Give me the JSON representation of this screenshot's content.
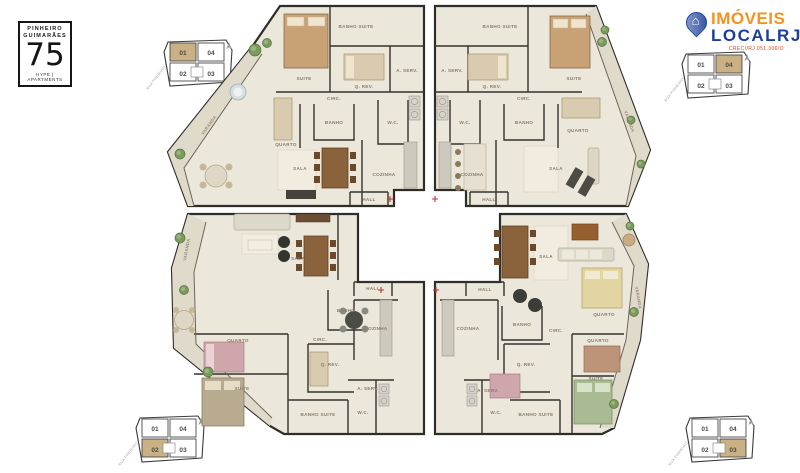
{
  "project": {
    "name_line1": "PINHEIRO",
    "name_line2": "GUIMARÃES",
    "number": "75",
    "subtitle": "HYPE | APARTMENTS"
  },
  "agency": {
    "name_line1": "IMÓVEIS",
    "name_line2": "LOCALRJ",
    "creci": "CRECI/RJ 051.306/O"
  },
  "keyplan": {
    "street": "RUA PINHEIRO GUIMARÃES",
    "units": [
      "01",
      "04",
      "02",
      "03"
    ],
    "instances": [
      {
        "position": "top-left",
        "highlight": "01"
      },
      {
        "position": "top-right",
        "highlight": "04"
      },
      {
        "position": "bottom-left",
        "highlight": "02"
      },
      {
        "position": "bottom-right",
        "highlight": "03"
      }
    ]
  },
  "floorplan": {
    "apartments": [
      {
        "unit": "01",
        "position": "top-left",
        "rooms": [
          {
            "label": "SUITE",
            "x": 146,
            "y": 80
          },
          {
            "label": "BANHO SUITE",
            "x": 198,
            "y": 28
          },
          {
            "label": "Q. REV.",
            "x": 206,
            "y": 88
          },
          {
            "label": "A. SERV.",
            "x": 249,
            "y": 72
          },
          {
            "label": "CIRC.",
            "x": 176,
            "y": 100
          },
          {
            "label": "QUARTO",
            "x": 128,
            "y": 146
          },
          {
            "label": "BANHO",
            "x": 176,
            "y": 124
          },
          {
            "label": "W.C.",
            "x": 235,
            "y": 124
          },
          {
            "label": "SALA",
            "x": 142,
            "y": 170
          },
          {
            "label": "COZINHA",
            "x": 226,
            "y": 176
          },
          {
            "label": "HALL",
            "x": 211,
            "y": 201
          },
          {
            "label": "VARANDA",
            "x": 52,
            "y": 126,
            "rot": -54
          }
        ]
      },
      {
        "unit": "04",
        "position": "top-right",
        "rooms": [
          {
            "label": "SUITE",
            "x": 416,
            "y": 80
          },
          {
            "label": "BANHO SUITE",
            "x": 342,
            "y": 28
          },
          {
            "label": "Q. REV.",
            "x": 334,
            "y": 88
          },
          {
            "label": "A. SERV.",
            "x": 294,
            "y": 72
          },
          {
            "label": "CIRC.",
            "x": 366,
            "y": 100
          },
          {
            "label": "QUARTO",
            "x": 420,
            "y": 132
          },
          {
            "label": "BANHO",
            "x": 366,
            "y": 124
          },
          {
            "label": "W.C.",
            "x": 307,
            "y": 124
          },
          {
            "label": "SALA",
            "x": 398,
            "y": 170
          },
          {
            "label": "COZINHA",
            "x": 314,
            "y": 176
          },
          {
            "label": "HALL",
            "x": 331,
            "y": 201
          },
          {
            "label": "VARANDA",
            "x": 470,
            "y": 122,
            "rot": 70
          }
        ]
      },
      {
        "unit": "02",
        "position": "bottom-left",
        "rooms": [
          {
            "label": "SALA",
            "x": 140,
            "y": 260
          },
          {
            "label": "VARANDA",
            "x": 30,
            "y": 250,
            "rot": -80
          },
          {
            "label": "QUARTO",
            "x": 80,
            "y": 342
          },
          {
            "label": "SUITE",
            "x": 84,
            "y": 390
          },
          {
            "label": "Q. REV.",
            "x": 172,
            "y": 366
          },
          {
            "label": "CIRC.",
            "x": 162,
            "y": 341
          },
          {
            "label": "BANHO",
            "x": 188,
            "y": 312
          },
          {
            "label": "COZINHA",
            "x": 218,
            "y": 330
          },
          {
            "label": "A. SERV.",
            "x": 210,
            "y": 390
          },
          {
            "label": "W.C.",
            "x": 205,
            "y": 414
          },
          {
            "label": "BANHO SUITE",
            "x": 160,
            "y": 416
          },
          {
            "label": "HALL",
            "x": 215,
            "y": 290
          }
        ]
      },
      {
        "unit": "03",
        "position": "bottom-right",
        "rooms": [
          {
            "label": "SALA",
            "x": 388,
            "y": 258
          },
          {
            "label": "VARANDA",
            "x": 479,
            "y": 298,
            "rot": 80
          },
          {
            "label": "QUARTO",
            "x": 446,
            "y": 316
          },
          {
            "label": "QUARTO",
            "x": 440,
            "y": 342
          },
          {
            "label": "SUITE",
            "x": 438,
            "y": 380
          },
          {
            "label": "Q. REV.",
            "x": 368,
            "y": 366
          },
          {
            "label": "CIRC.",
            "x": 398,
            "y": 332
          },
          {
            "label": "BANHO",
            "x": 364,
            "y": 326
          },
          {
            "label": "COZINHA",
            "x": 310,
            "y": 330
          },
          {
            "label": "A. SERV.",
            "x": 330,
            "y": 392
          },
          {
            "label": "W.C.",
            "x": 338,
            "y": 414
          },
          {
            "label": "BANHO SUITE",
            "x": 378,
            "y": 416
          },
          {
            "label": "HALL",
            "x": 327,
            "y": 291
          }
        ]
      }
    ]
  },
  "colors": {
    "keyplan_highlight": "#c9b183",
    "agency_orange": "#f6921e",
    "agency_blue": "#1d3f99",
    "wall": "#35322c",
    "floor": "#ece7db",
    "varanda": "#e0dacb"
  }
}
